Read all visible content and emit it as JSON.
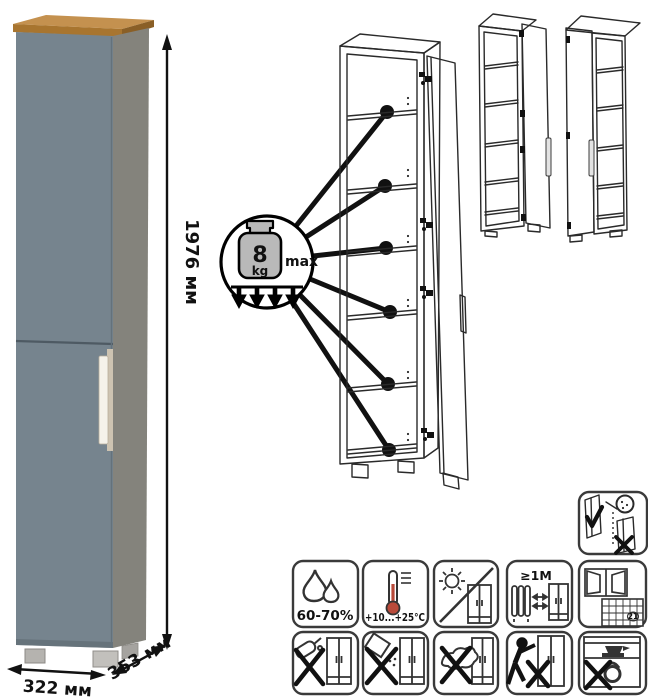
{
  "product": {
    "dimensions": {
      "height": "1976 мм",
      "width": "322 мм",
      "depth": "353 мм"
    }
  },
  "load_limit": {
    "value": "8",
    "unit": "kg",
    "qualifier": "max"
  },
  "care_labels": {
    "humidity": "60-70%",
    "temperature": "+10...+25°C",
    "min_distance": "≥1М",
    "calendar_day": "21"
  },
  "icon_names": {
    "single": "door-adjustment-check-icon",
    "row1": [
      "humidity-icon",
      "temperature-icon",
      "no-direct-sunlight-icon",
      "heat-source-distance-icon",
      "ventilation-icon"
    ],
    "row2": [
      "no-water-cleaning-icon",
      "no-abrasive-cleaners-icon",
      "no-wet-wiping-icon",
      "no-dragging-icon",
      "no-overloading-icon"
    ]
  },
  "colors": {
    "door_front": "#76848e",
    "carcass_side": "#84837c",
    "wood_trim_top": "#c4914f",
    "wood_trim_front": "#a8752f",
    "wood_trim_side": "#8a5f26",
    "handle": "#f5f2ea",
    "variant_door": "#9d9d9d",
    "drawing_line": "#2a2a2a"
  }
}
